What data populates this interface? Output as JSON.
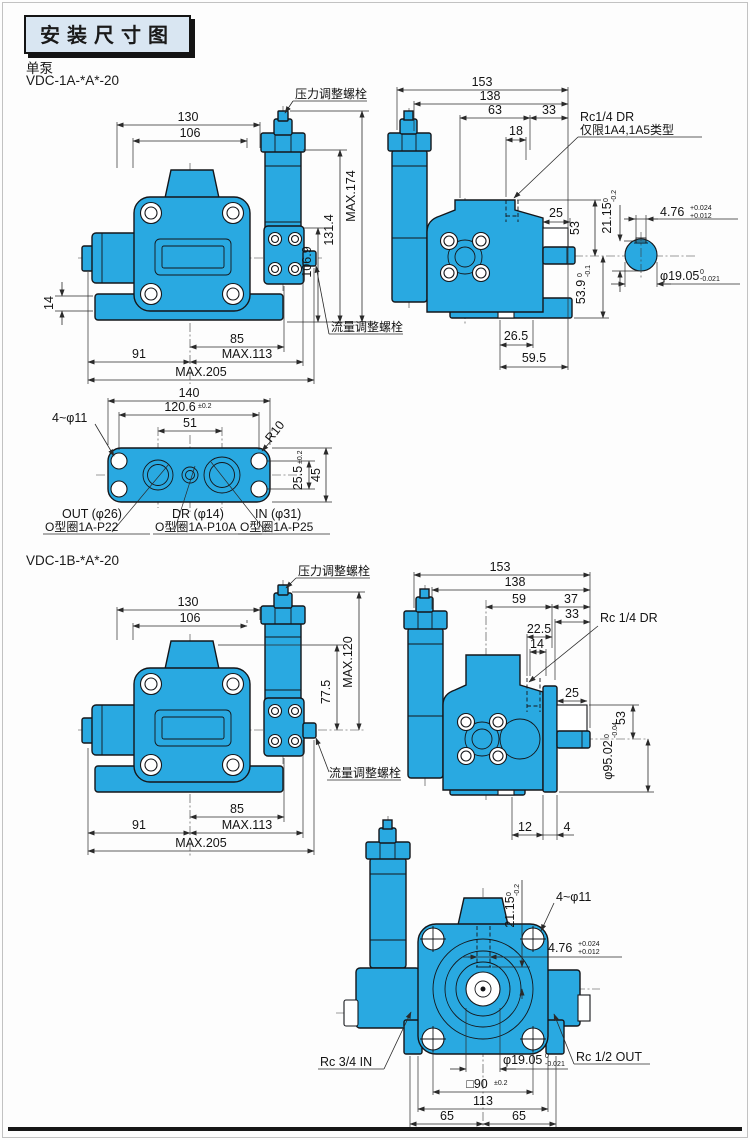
{
  "page": {
    "title": "安装尺寸图",
    "pump_type": "单泵",
    "model_a": "VDC-1A-*A*-20",
    "model_b": "VDC-1B-*A*-20"
  },
  "colors": {
    "pump_fill": "#29a9e1",
    "outline": "#14161a",
    "dim_line": "#2a2a2a",
    "title_bg": "#d9e6f2",
    "frame": "#1a1a1a"
  },
  "labels": {
    "pressure_bolt": "压力调整螺栓",
    "flow_bolt": "流量调整螺栓",
    "rc14_dr": "Rc1/4  DR",
    "rc14_dr_note": "仅限1A4,1A5类型",
    "rc14_dr_b": "Rc  1/4 DR",
    "mount_holes": "4~φ11",
    "corner_r": "R10",
    "out_port": "OUT (φ26)",
    "out_oring": "O型圈1A-P22",
    "dr_port": "DR (φ14)",
    "dr_oring": "O型圈1A-P10A",
    "in_port": "IN (φ31)",
    "in_oring": "O型圈1A-P25",
    "rc34_in": "Rc 3/4 IN",
    "rc12_out": "Rc  1/2 OUT"
  },
  "a_front": {
    "w130": "130",
    "w106": "106",
    "h14": "14",
    "w85": "85",
    "w91": "91",
    "max113": "MAX.113",
    "max205": "MAX.205",
    "h106_9": "106.9",
    "h131_4": "131.4",
    "max174": "MAX.174"
  },
  "a_side": {
    "w153": "153",
    "w138": "138",
    "w63": "63",
    "w33": "33",
    "w18": "18",
    "w25": "25",
    "h53": "53",
    "h53_9": "53.9",
    "h53_9_tol_hi": "0",
    "h53_9_tol_lo": "-0.1",
    "w26_5": "26.5",
    "w59_5": "59.5",
    "h21_15": "21.15",
    "h21_15_tol_hi": "0",
    "h21_15_tol_lo": "-0.2",
    "w4_76": "4.76",
    "w4_76_tol_hi": "+0.024",
    "w4_76_tol_lo": "+0.012",
    "d19_05": "φ19.05",
    "d19_05_tol_hi": "0",
    "d19_05_tol_lo": "-0.021"
  },
  "a_bottom": {
    "w140": "140",
    "w120_6": "120.6",
    "w120_6_tol": "±0.2",
    "w51": "51",
    "h25_5": "25.5",
    "h25_5_tol": "±0.2",
    "h45": "45"
  },
  "b_front": {
    "w130": "130",
    "w106": "106",
    "h77_5": "77.5",
    "max120": "MAX.120",
    "w85": "85",
    "w91": "91",
    "max113": "MAX.113",
    "max205": "MAX.205"
  },
  "b_side": {
    "w153": "153",
    "w138": "138",
    "w59": "59",
    "w37": "37",
    "w33": "33",
    "w22_5": "22.5",
    "w14": "14",
    "w25": "25",
    "h53": "53",
    "d95": "φ95.02",
    "d95_tol_hi": "0",
    "d95_tol_lo": "-0.04",
    "w12": "12",
    "w4": "4"
  },
  "b_rear": {
    "h21_15": "21.15",
    "h21_15_tol_hi": "0",
    "h21_15_tol_lo": "-0.2",
    "w4_76": "4.76",
    "w4_76_tol_hi": "+0.024",
    "w4_76_tol_lo": "+0.012",
    "d19_05": "φ19.05",
    "d19_05_tol_hi": "0",
    "d19_05_tol_lo": "-0.021",
    "sq90": "□90",
    "sq90_tol": "±0.2",
    "w113": "113",
    "w65_l": "65",
    "w65_r": "65"
  }
}
